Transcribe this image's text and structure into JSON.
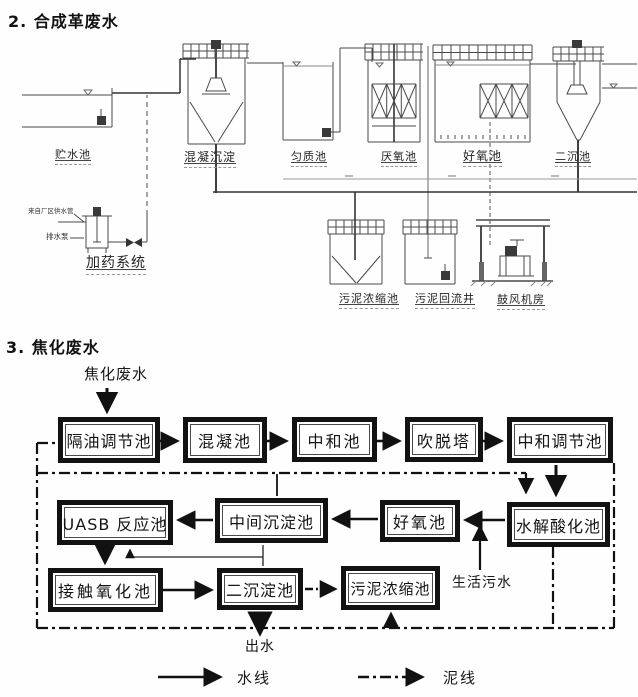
{
  "colors": {
    "ink": "#1a1a1a",
    "thin_line": "#4a4a4a",
    "flow_border": "#121212",
    "background": "#ffffff"
  },
  "synthetic": {
    "title": "2. 合成革废水",
    "labels": {
      "storage": "贮水池",
      "coag_sed": "混凝沉淀",
      "homogenization": "匀质池",
      "anaerobic": "厌氧池",
      "aerobic": "好氧池",
      "secondary": "二沉池",
      "dosing_system": "加药系统",
      "plant_water": "来自厂区供水管",
      "drain_pump": "排水泵",
      "sludge_thickener": "污泥浓缩池",
      "sludge_return_well": "污泥回流井",
      "blower_room": "鼓风机房"
    }
  },
  "coking": {
    "title": "3. 焦化废水",
    "influent": "焦化废水",
    "boxes": {
      "oil_sep": "隔油调节池",
      "coagulation": "混凝池",
      "neutralization": "中和池",
      "stripping": "吹脱塔",
      "neutral_reg": "中和调节池",
      "uasb": "UASB 反应池",
      "mid_sed": "中间沉淀池",
      "aerobic": "好氧池",
      "hydrolysis": "水解酸化池",
      "contact_ox": "接触氧化池",
      "secondary_sed": "二沉淀池",
      "sludge_thickener": "污泥浓缩池"
    },
    "notes": {
      "domestic": "生活污水",
      "effluent": "出水"
    },
    "legend": {
      "water": "水线",
      "sludge": "泥线"
    }
  }
}
